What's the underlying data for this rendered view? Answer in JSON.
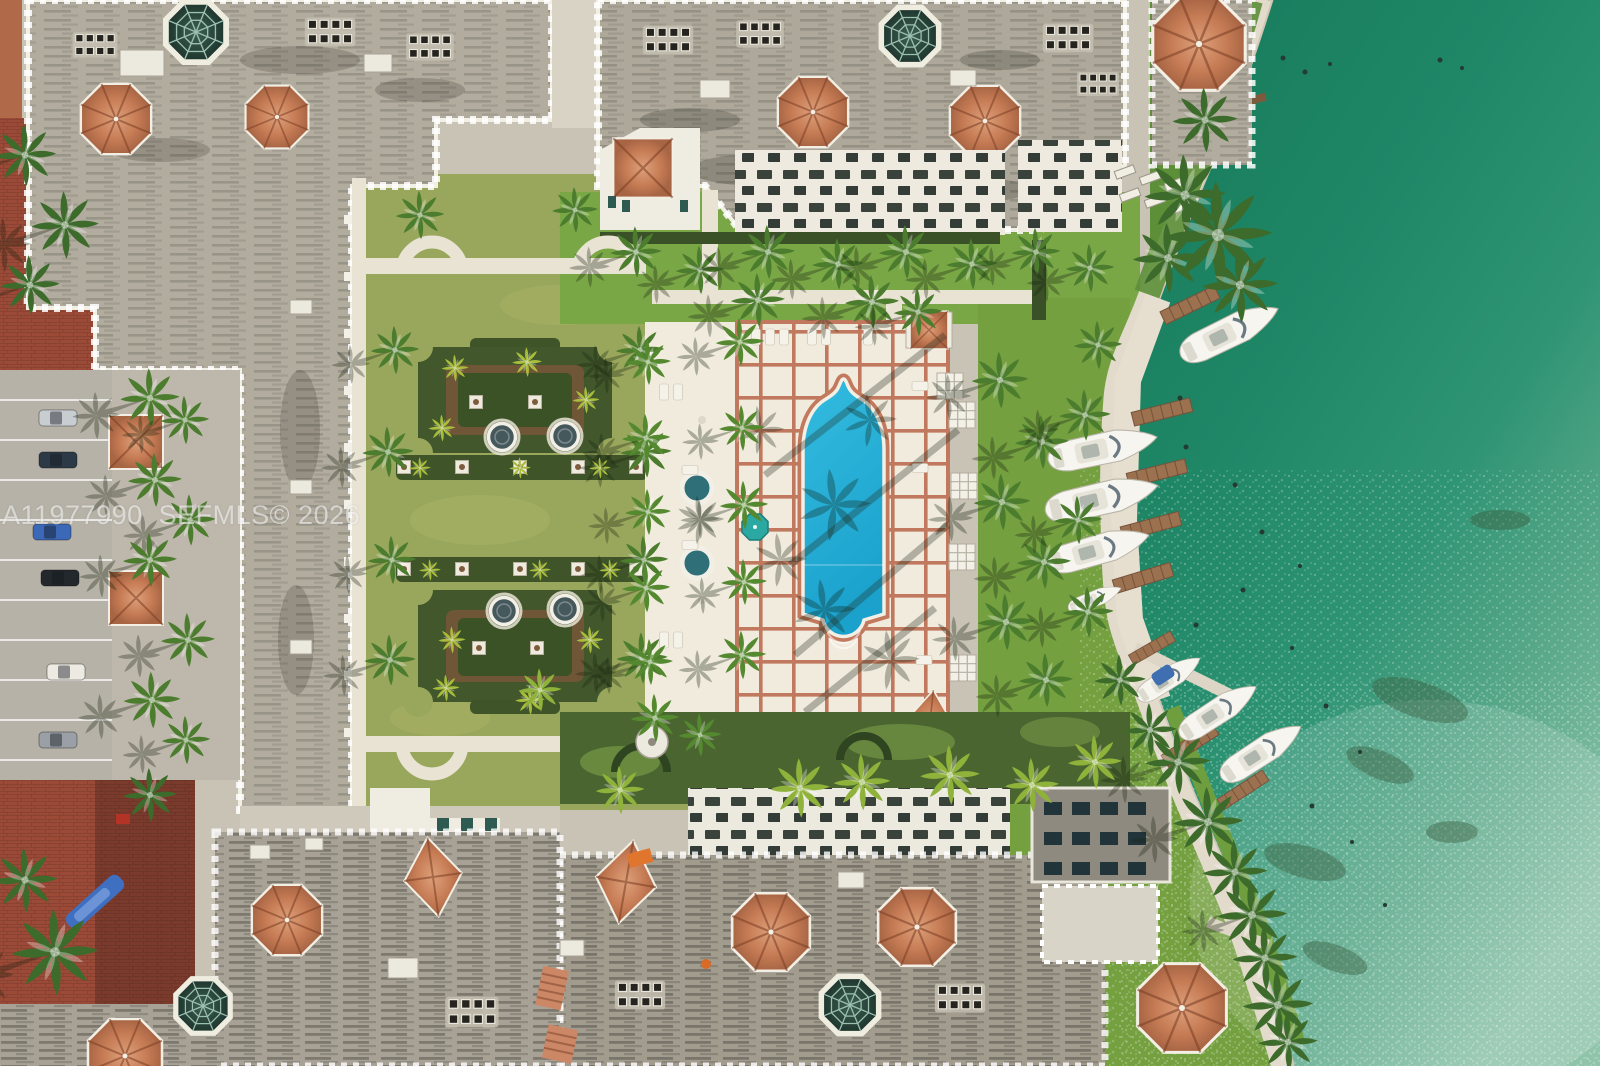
{
  "watermark": {
    "text": "A11977990  SEFMLS© 2026"
  },
  "scene": {
    "type": "aerial-photo",
    "setting": "Overhead drone view of a waterfront Mediterranean-style condominium complex with a formal courtyard garden, resort pool deck and private marina on emerald bay water",
    "features": [
      "gray mottled condominium rooftops with white crenellated parapets",
      "octagonal terracotta tile tower roofs",
      "dark green glass atrium domes with spider-web glazing",
      "formal parterre garden with two hedge beds, four round fountains and white planters",
      "white paved walkways with curved alcoves",
      "resort pool deck with terracotta grid tiles",
      "arched lap pool with scalloped steps",
      "two round spas and a teal umbrella",
      "rows of rooftop AC units",
      "surface parking with cars",
      "red brick courtyards",
      "palm trees casting long shadows",
      "zigzag seawall promenade with wooden finger docks",
      "eight white boats docked at the marina",
      "emerald-green bay water with sun glitter"
    ]
  },
  "palette": {
    "water_deep": "#187a5c",
    "water_sparkle": "#8fc4ab",
    "pool": "#2ab4d9",
    "deck_tile": "#f1ebdd",
    "deck_grout": "#c0795e",
    "terracotta": "#c67c55",
    "roof_gray": "#b2ac9f",
    "roof_gray_dark": "#a29c8f",
    "lawn_courtyard": "#99a75d",
    "lawn_bright": "#7aa746",
    "shore_grass": "#6f9e3e",
    "hedge": "#3f5429",
    "brick": "#9c4a38",
    "path": "#e9e3d4",
    "dome_glass": "#2c4a41",
    "boat_hull": "#f6f5f0",
    "dock_wood": "#9b7150",
    "umbrella_teal": "#2ba8a2",
    "watermark_color": "#ffffff"
  }
}
